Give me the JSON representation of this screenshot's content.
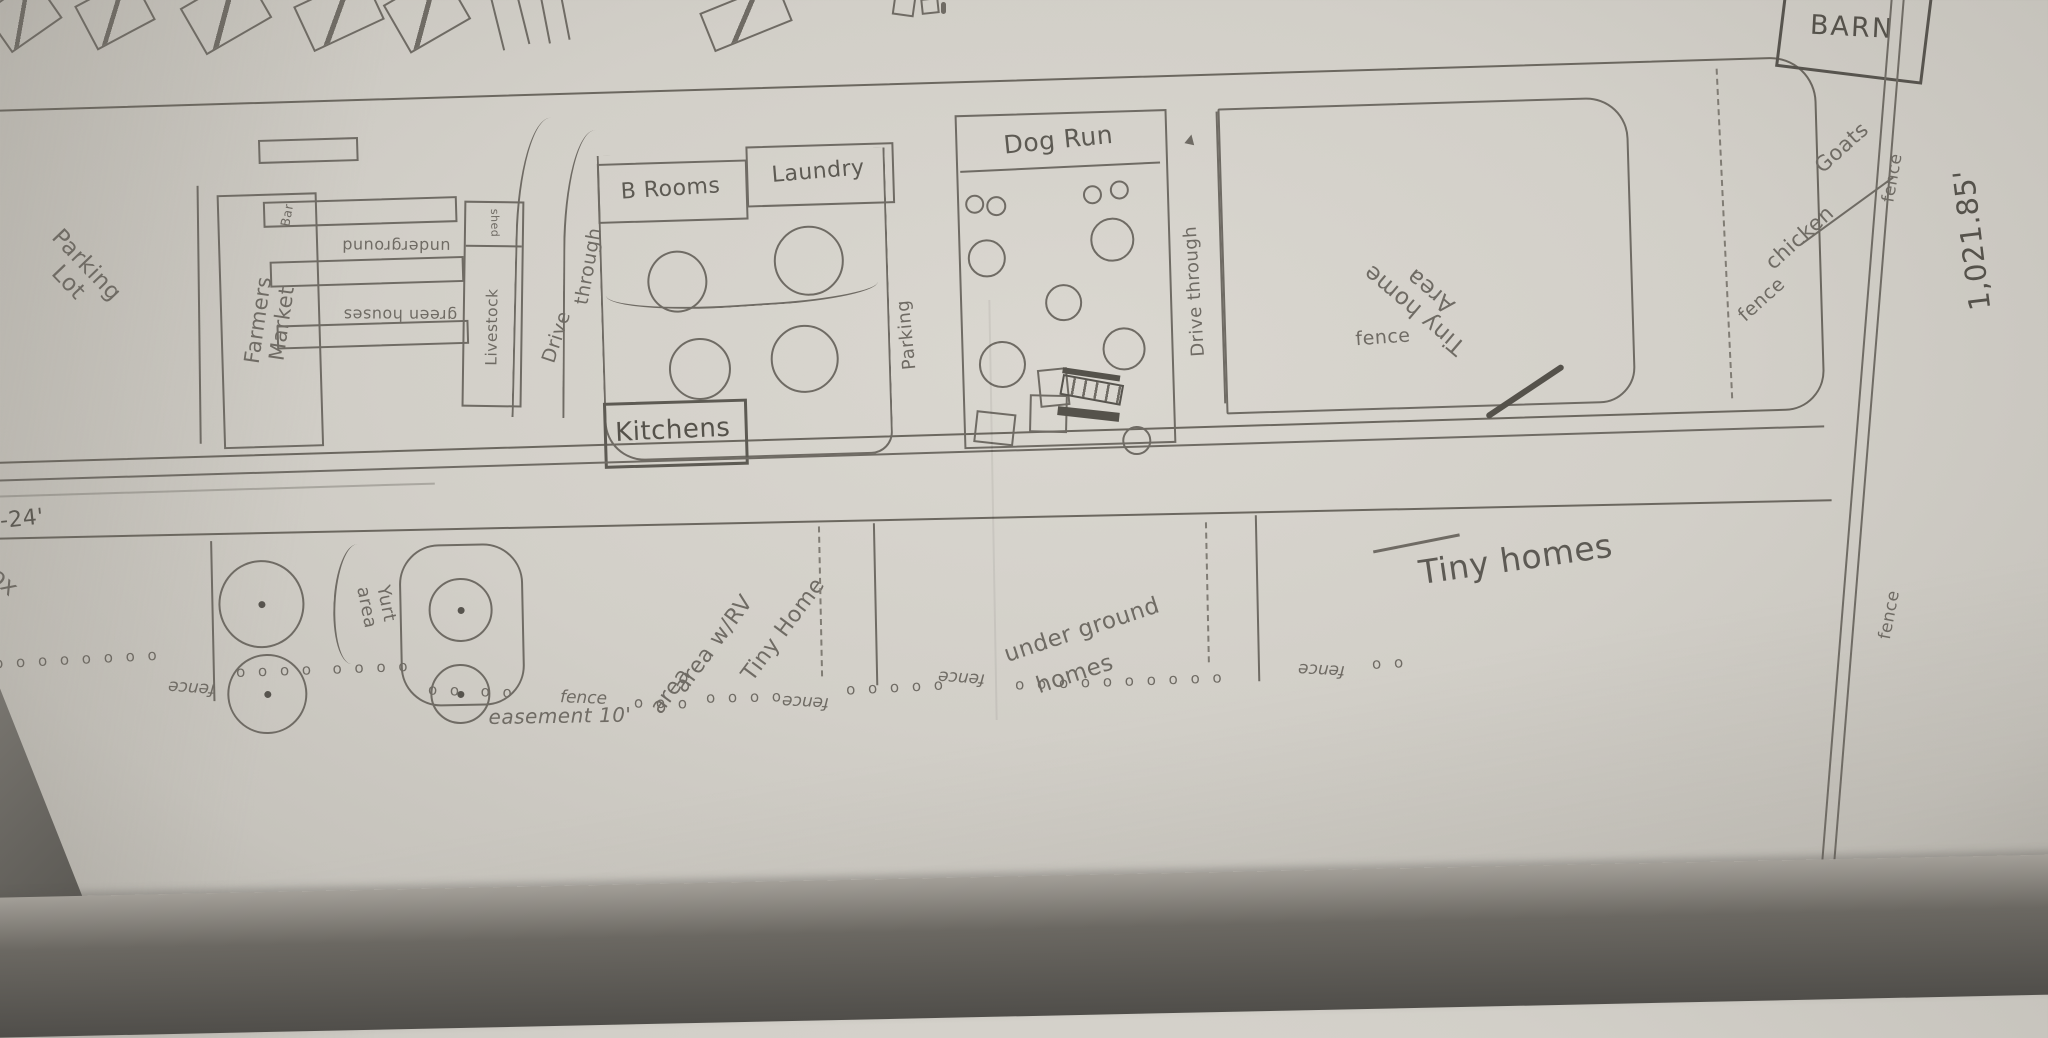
{
  "labels": {
    "parking_lot_line1": "Parking",
    "parking_lot_line2": "Lot",
    "farmers_line1": "Farmers",
    "farmers_line2": "Market",
    "bar": "Bar",
    "underground": "underground",
    "green_houses": "green houses",
    "shed": "shed",
    "livestock": "Livestock",
    "drive_left_1": "Drive",
    "drive_left_2": "through",
    "b_rooms": "B Rooms",
    "laundry": "Laundry",
    "kitchens": "Kitchens",
    "parking": "Parking",
    "dog_run": "Dog Run",
    "drive_through_right": "Drive through",
    "tiny_home_area_line1": "Tiny home",
    "tiny_home_area_line2": "Area",
    "fence_band": "fence",
    "fence_goats": "fence",
    "goats": "Goats",
    "chicken": "chicken",
    "fence_right_top": "fence",
    "barn": "BARN",
    "boundary_length": "1,021.85'",
    "road_width": "-24'",
    "partial_text": "ox",
    "yurt_line1": "Yurt",
    "yurt_line2": "area",
    "tiny_rv_line1": "Tiny Home",
    "tiny_rv_line2": "area w/RV",
    "tiny_rv_line3": "area",
    "underground_homes_line1": "under ground",
    "underground_homes_line2": "homes",
    "tiny_homes": "Tiny homes",
    "easement": "easement 10'",
    "fence_bottom_right": "fence"
  },
  "fence_line": {
    "segments": [
      {
        "x": -6,
        "y": 650,
        "rot": -3,
        "kind": "dots",
        "text": "o o o o o o o o"
      },
      {
        "x": 168,
        "y": 678,
        "rot": 184,
        "kind": "word",
        "text": "fence"
      },
      {
        "x": 236,
        "y": 660,
        "rot": -2,
        "kind": "dots",
        "text": "o o o o  o o o o"
      },
      {
        "x": 428,
        "y": 682,
        "rot": 2,
        "kind": "dots",
        "text": "o o  o o"
      },
      {
        "x": 560,
        "y": 688,
        "rot": 2,
        "kind": "word",
        "text": "fence"
      },
      {
        "x": 634,
        "y": 694,
        "rot": 1,
        "kind": "dots",
        "text": "o o o"
      },
      {
        "x": 706,
        "y": 688,
        "rot": -1,
        "kind": "dots",
        "text": "o o o o"
      },
      {
        "x": 782,
        "y": 692,
        "rot": 183,
        "kind": "word",
        "text": "fence"
      },
      {
        "x": 846,
        "y": 678,
        "rot": -3,
        "kind": "dots",
        "text": "o o o o o"
      },
      {
        "x": 938,
        "y": 668,
        "rot": 184,
        "kind": "word",
        "text": "fence"
      },
      {
        "x": 1015,
        "y": 672,
        "rot": -2,
        "kind": "dots",
        "text": "o o o o o o o o o o"
      },
      {
        "x": 1298,
        "y": 660,
        "rot": 183,
        "kind": "word",
        "text": "fence"
      },
      {
        "x": 1372,
        "y": 654,
        "rot": -3,
        "kind": "dots",
        "text": "o o"
      }
    ]
  }
}
